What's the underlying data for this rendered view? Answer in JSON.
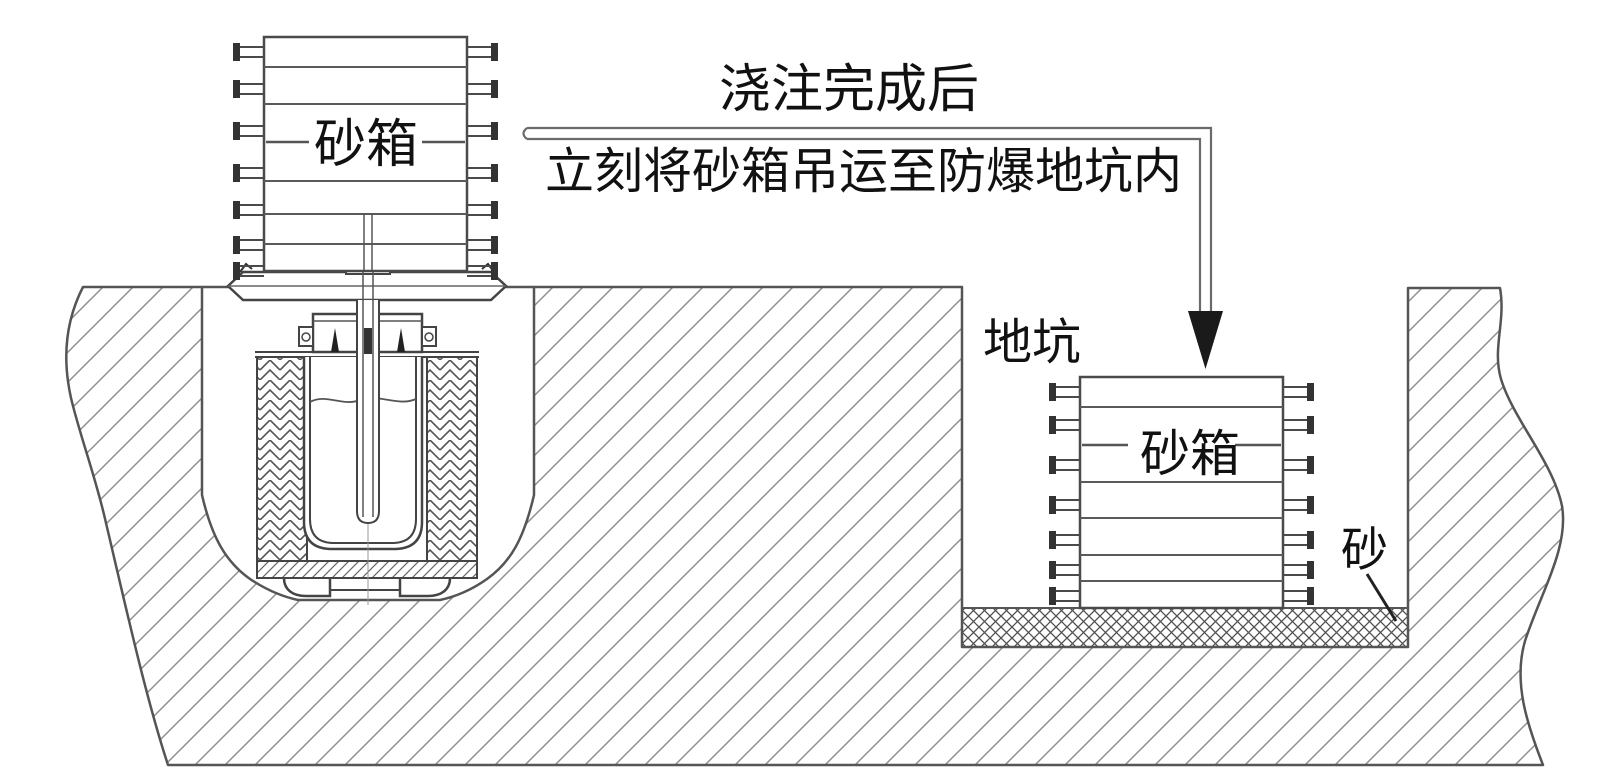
{
  "diagram": {
    "annotation": {
      "line1": "浇注完成后",
      "line2": "立刻将砂箱吊运至防爆地坑内"
    },
    "left_flask": {
      "label": "砂箱"
    },
    "right_flask": {
      "label": "砂箱"
    },
    "pit": {
      "label": "地坑"
    },
    "sand": {
      "label": "砂"
    },
    "colors": {
      "line": "#4a4a4a",
      "thin_line": "#666666",
      "hatch": "#8f8f8f",
      "text": "#111111",
      "arrowhead": "#1a1a1a",
      "background": "#ffffff"
    }
  }
}
